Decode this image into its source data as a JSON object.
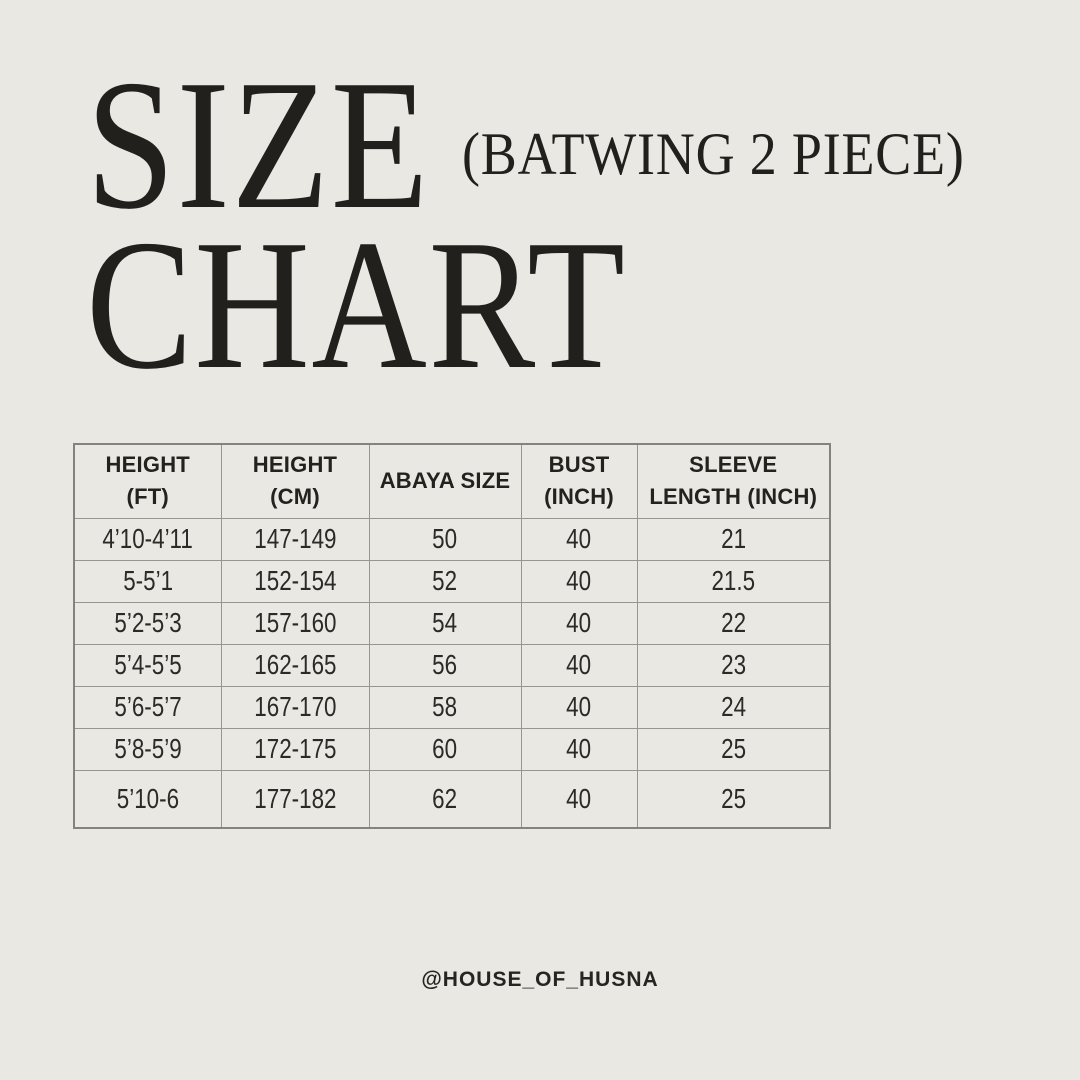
{
  "page": {
    "background_color": "#e9e8e2",
    "text_color": "#21201d",
    "border_color": "#96958f"
  },
  "title": {
    "size": "SIZE",
    "chart": "CHART",
    "subtitle": "(BATWING 2 PIECE)"
  },
  "table": {
    "headers": [
      {
        "line1": "HEIGHT",
        "line2": "(FT)"
      },
      {
        "line1": "HEIGHT",
        "line2": "(CM)"
      },
      {
        "line1": "ABAYA SIZE",
        "line2": ""
      },
      {
        "line1": "BUST",
        "line2": "(INCH)"
      },
      {
        "line1": "SLEEVE",
        "line2": "LENGTH (INCH)"
      }
    ],
    "rows": [
      [
        "4’10-4’11",
        "147-149",
        "50",
        "40",
        "21"
      ],
      [
        "5-5’1",
        "152-154",
        "52",
        "40",
        "21.5"
      ],
      [
        "5’2-5’3",
        "157-160",
        "54",
        "40",
        "22"
      ],
      [
        "5’4-5’5",
        "162-165",
        "56",
        "40",
        "23"
      ],
      [
        "5’6-5’7",
        "167-170",
        "58",
        "40",
        "24"
      ],
      [
        "5’8-5’9",
        "172-175",
        "60",
        "40",
        "25"
      ],
      [
        "5’10-6",
        "177-182",
        "62",
        "40",
        "25"
      ]
    ]
  },
  "footer": {
    "handle": "@HOUSE_OF_HUSNA"
  },
  "chart_data": {
    "type": "table",
    "title": "SIZE CHART (BATWING 2 PIECE)",
    "columns": [
      "HEIGHT (FT)",
      "HEIGHT (CM)",
      "ABAYA SIZE",
      "BUST (INCH)",
      "SLEEVE LENGTH (INCH)"
    ],
    "rows": [
      [
        "4’10-4’11",
        "147-149",
        50,
        40,
        21
      ],
      [
        "5-5’1",
        "152-154",
        52,
        40,
        21.5
      ],
      [
        "5’2-5’3",
        "157-160",
        54,
        40,
        22
      ],
      [
        "5’4-5’5",
        "162-165",
        56,
        40,
        23
      ],
      [
        "5’6-5’7",
        "167-170",
        58,
        40,
        24
      ],
      [
        "5’8-5’9",
        "172-175",
        60,
        40,
        25
      ],
      [
        "5’10-6",
        "177-182",
        62,
        40,
        25
      ]
    ]
  }
}
